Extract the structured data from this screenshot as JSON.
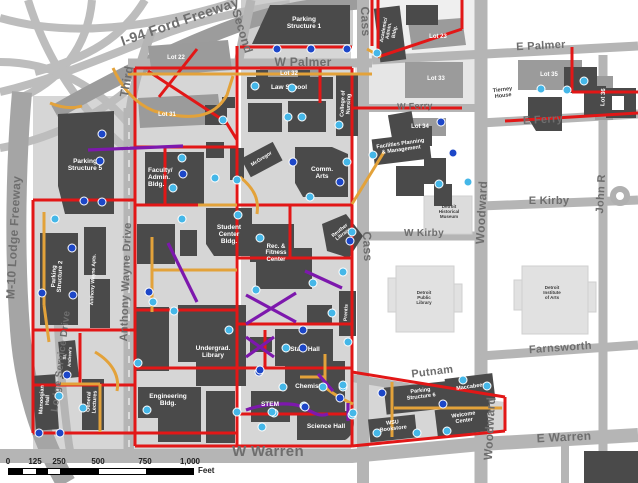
{
  "colors": {
    "route_red": "#e21717",
    "route_orange": "#e3a23a",
    "route_purple": "#7d18ad",
    "marker_cyan": "#45b7e8",
    "marker_blue": "#1d47c8",
    "building_dark": "#4a4a4a",
    "lot_gray": "#9b9b9b"
  },
  "streets": {
    "i94": "I-94 Ford Freeway",
    "third": "Third",
    "second": "Second",
    "cass_top": "Cass",
    "cass_mid": "Cass",
    "w_palmer": "W Palmer",
    "e_palmer": "E Palmer",
    "w_ferry": "W Ferry",
    "e_ferry": "E Ferry",
    "w_kirby": "W Kirby",
    "e_kirby": "E Kirby",
    "john_r": "John R",
    "woodward": "Woodward",
    "woodward2": "Woodward",
    "farnsworth": "Farnsworth",
    "putnam": "Putnam",
    "e_warren": "E Warren",
    "w_warren": "W Warren",
    "m10": "M-10 Lodge Freeway",
    "lodge_service": "Lodge Service Drive",
    "anthony_wayne": "Anthony Wayne Drive"
  },
  "buildings": {
    "ps1": "Parking\nStructure 1",
    "ps5": "Parking\nStructure 5",
    "ps2": "Parking\nStructure 2",
    "aw_apts": "Anthony Wayne Apts.",
    "faculty": "Faculty/\nAdmin.\nBldg.",
    "student_center": "Student\nCenter\nBldg.",
    "law_school": "Law School",
    "nursing": "College of\nNursing",
    "academic": "Academic/\nAdmin.\nBldg.",
    "mcgregor": "McGregor",
    "comm_arts": "Comm.\nArts",
    "reuther": "Reuther\nLibrary",
    "rec_fitness": "Rec. &\nFitness\nCenter",
    "prentis": "Prentis",
    "state_hall": "State Hall",
    "undergrad": "Undergrad.\nLibrary",
    "engineering": "Engineering\nBldg.",
    "chemistry": "Chemistry",
    "stem": "STEM",
    "science_hall": "Science Hall",
    "manoogian": "Manoogian\nHall",
    "gen_lectures": "General\nLectures",
    "st_andrews": "St.\nAndrew's",
    "facilities": "Facilities Planning\n& Management",
    "maccabees": "Maccabees",
    "ps6": "Parking\nStructure 6",
    "bookstore": "WSU\nBookstore",
    "welcome": "Welcome\nCenter",
    "tierney": "Tierney\nHouse",
    "hist_museum": "Detroit\nHistorical\nMuseum",
    "public_library": "Detroit\nPublic\nLibrary",
    "institute_arts": "Detroit\nInstitute\nof Arts"
  },
  "lots": {
    "lot22": "Lot 22",
    "lot31": "Lot 31",
    "lot32": "Lot 32",
    "lot23": "Lot 23",
    "lot33": "Lot 33",
    "lot34": "Lot 34",
    "lot35": "Lot 35",
    "lot36": "Lot 36"
  },
  "scalebar": {
    "ticks": [
      "0",
      "125",
      "250",
      "500",
      "750",
      "1,000"
    ],
    "unit": "Feet"
  },
  "markers": {
    "cyan": [
      [
        377,
        53
      ],
      [
        255,
        86
      ],
      [
        292,
        88
      ],
      [
        288,
        117
      ],
      [
        302,
        117
      ],
      [
        339,
        125
      ],
      [
        223,
        120
      ],
      [
        182,
        158
      ],
      [
        173,
        188
      ],
      [
        215,
        178
      ],
      [
        237,
        180
      ],
      [
        347,
        162
      ],
      [
        310,
        197
      ],
      [
        55,
        219
      ],
      [
        182,
        219
      ],
      [
        238,
        215
      ],
      [
        153,
        302
      ],
      [
        174,
        311
      ],
      [
        229,
        330
      ],
      [
        138,
        363
      ],
      [
        59,
        396
      ],
      [
        83,
        408
      ],
      [
        147,
        410
      ],
      [
        237,
        412
      ],
      [
        256,
        290
      ],
      [
        313,
        283
      ],
      [
        286,
        348
      ],
      [
        283,
        387
      ],
      [
        274,
        413
      ],
      [
        304,
        406
      ],
      [
        260,
        238
      ],
      [
        343,
        272
      ],
      [
        332,
        313
      ],
      [
        352,
        232
      ],
      [
        348,
        342
      ],
      [
        323,
        387
      ],
      [
        343,
        387
      ],
      [
        272,
        412
      ],
      [
        262,
        427
      ],
      [
        352,
        415
      ],
      [
        377,
        433
      ],
      [
        373,
        155
      ],
      [
        468,
        182
      ],
      [
        439,
        184
      ],
      [
        541,
        89
      ],
      [
        567,
        90
      ],
      [
        584,
        81
      ],
      [
        343,
        385
      ],
      [
        353,
        413
      ],
      [
        463,
        380
      ],
      [
        487,
        386
      ],
      [
        417,
        433
      ],
      [
        447,
        431
      ]
    ],
    "blue": [
      [
        277,
        49
      ],
      [
        311,
        49
      ],
      [
        347,
        49
      ],
      [
        102,
        134
      ],
      [
        100,
        161
      ],
      [
        183,
        174
      ],
      [
        293,
        162
      ],
      [
        340,
        182
      ],
      [
        84,
        201
      ],
      [
        102,
        202
      ],
      [
        72,
        248
      ],
      [
        42,
        293
      ],
      [
        73,
        295
      ],
      [
        149,
        292
      ],
      [
        67,
        375
      ],
      [
        39,
        433
      ],
      [
        60,
        433
      ],
      [
        303,
        330
      ],
      [
        303,
        348
      ],
      [
        259,
        372
      ],
      [
        350,
        241
      ],
      [
        441,
        122
      ],
      [
        453,
        153
      ],
      [
        382,
        393
      ],
      [
        443,
        404
      ],
      [
        340,
        398
      ],
      [
        305,
        407
      ],
      [
        260,
        370
      ]
    ]
  }
}
